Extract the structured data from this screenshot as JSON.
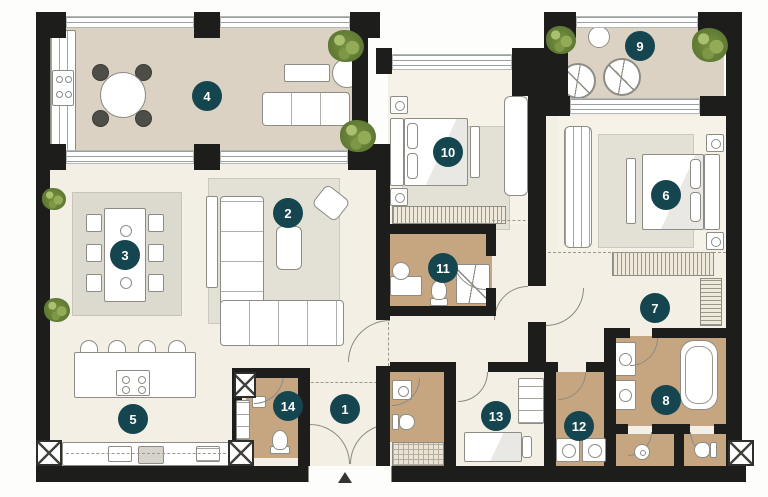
{
  "markers": [
    {
      "num": "1"
    },
    {
      "num": "2"
    },
    {
      "num": "3"
    },
    {
      "num": "4"
    },
    {
      "num": "5"
    },
    {
      "num": "6"
    },
    {
      "num": "7"
    },
    {
      "num": "8"
    },
    {
      "num": "9"
    },
    {
      "num": "10"
    },
    {
      "num": "11"
    },
    {
      "num": "12"
    },
    {
      "num": "13"
    },
    {
      "num": "14"
    }
  ],
  "palette": {
    "wall": "#1d1d1b",
    "balcony_floor": "#dbd2c4",
    "interior_floor": "#f3efe4",
    "wet_room_floor": "#c6a681",
    "marker_bg": "#15454f",
    "marker_text": "#ffffff",
    "plant_green": "#77913f",
    "rug": "#e3e0d6"
  }
}
